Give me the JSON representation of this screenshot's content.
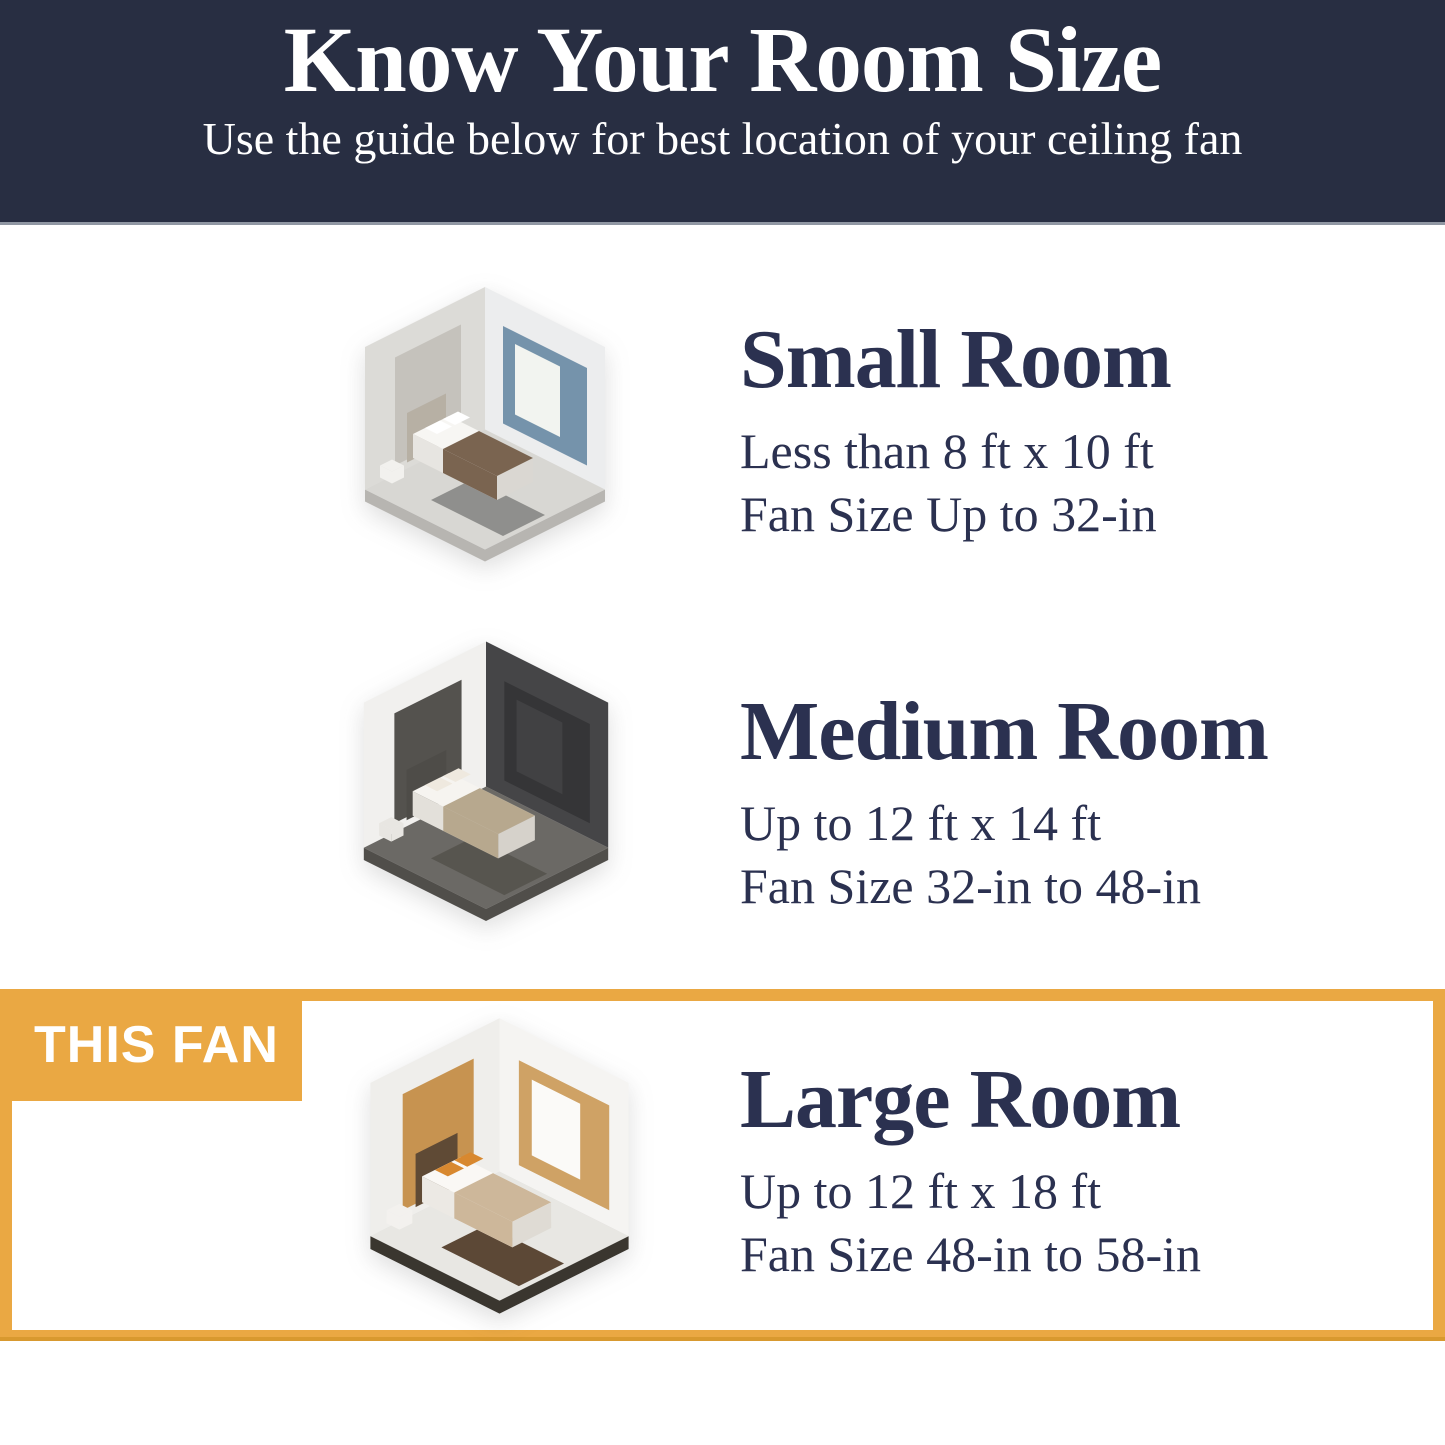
{
  "header": {
    "title": "Know Your Room Size",
    "subtitle": "Use the guide below for best location of your ceiling fan"
  },
  "badge": {
    "label": "THIS FAN"
  },
  "colors": {
    "header_bg": "#282e42",
    "header_divider": "#9097a3",
    "text_navy": "#2b3150",
    "accent_orange": "#eaa843",
    "accent_orange_dark": "#d8992f",
    "page_bg": "#ffffff"
  },
  "sections": [
    {
      "id": "small-room",
      "title": "Small Room",
      "size_range": "Less than 8 ft x 10 ft",
      "fan_size": "Fan Size Up to 32-in",
      "highlighted": false,
      "illustration": {
        "name": "small-bedroom-isometric-illustration",
        "palette": {
          "wall_left": "#dcdbd7",
          "wall_left_accent": "#c5c2bc",
          "wall_right": "#ecedee",
          "wall_right_accent": "#7593ab",
          "window": "#f2f4f0",
          "floor": "#d8d7d3",
          "floor_edge": "#b7b5b1",
          "rug": "#8f8f8d",
          "headboard": "#b7b0a4",
          "bed_side": "#e7e5e1",
          "bed_foot": "#dad7d2",
          "bed_top": "#f7f6f3",
          "blanket": "#7a6450",
          "pillow": "#ffffff",
          "stand": "#f2f1ee"
        }
      }
    },
    {
      "id": "medium-room",
      "title": "Medium Room",
      "size_range": "Up to 12 ft x 14 ft",
      "fan_size": "Fan Size 32-in to 48-in",
      "highlighted": false,
      "illustration": {
        "name": "medium-bedroom-isometric-illustration",
        "palette": {
          "wall_left": "#f1f0ee",
          "wall_left_accent": "#54524e",
          "wall_right": "#454547",
          "wall_right_accent": "#353537",
          "window": "#414143",
          "floor": "#6b6965",
          "floor_edge": "#504e4a",
          "rug": "#57554f",
          "headboard": "#4e4c48",
          "bed_side": "#e3e0da",
          "bed_foot": "#d6d2cb",
          "bed_top": "#f6f4f0",
          "blanket": "#b7a88e",
          "pillow": "#efe9df",
          "stand": "#e8e6e2"
        }
      }
    },
    {
      "id": "large-room",
      "title": "Large Room",
      "size_range": "Up to 12 ft x 18 ft",
      "fan_size": "Fan Size 48-in to 58-in",
      "highlighted": true,
      "illustration": {
        "name": "large-bedroom-isometric-illustration",
        "palette": {
          "wall_left": "#efeeeb",
          "wall_left_accent": "#c79350",
          "wall_right": "#f5f4f2",
          "wall_right_accent": "#cfa265",
          "window": "#fbfaf8",
          "floor": "#e8e7e3",
          "floor_edge": "#3a362f",
          "rug": "#5c4836",
          "headboard": "#5f4a35",
          "bed_side": "#ece9e4",
          "bed_foot": "#dfdbd4",
          "bed_top": "#faf8f5",
          "blanket": "#cdb79a",
          "pillow": "#d8882f",
          "stand": "#f3f1ee"
        }
      }
    }
  ]
}
